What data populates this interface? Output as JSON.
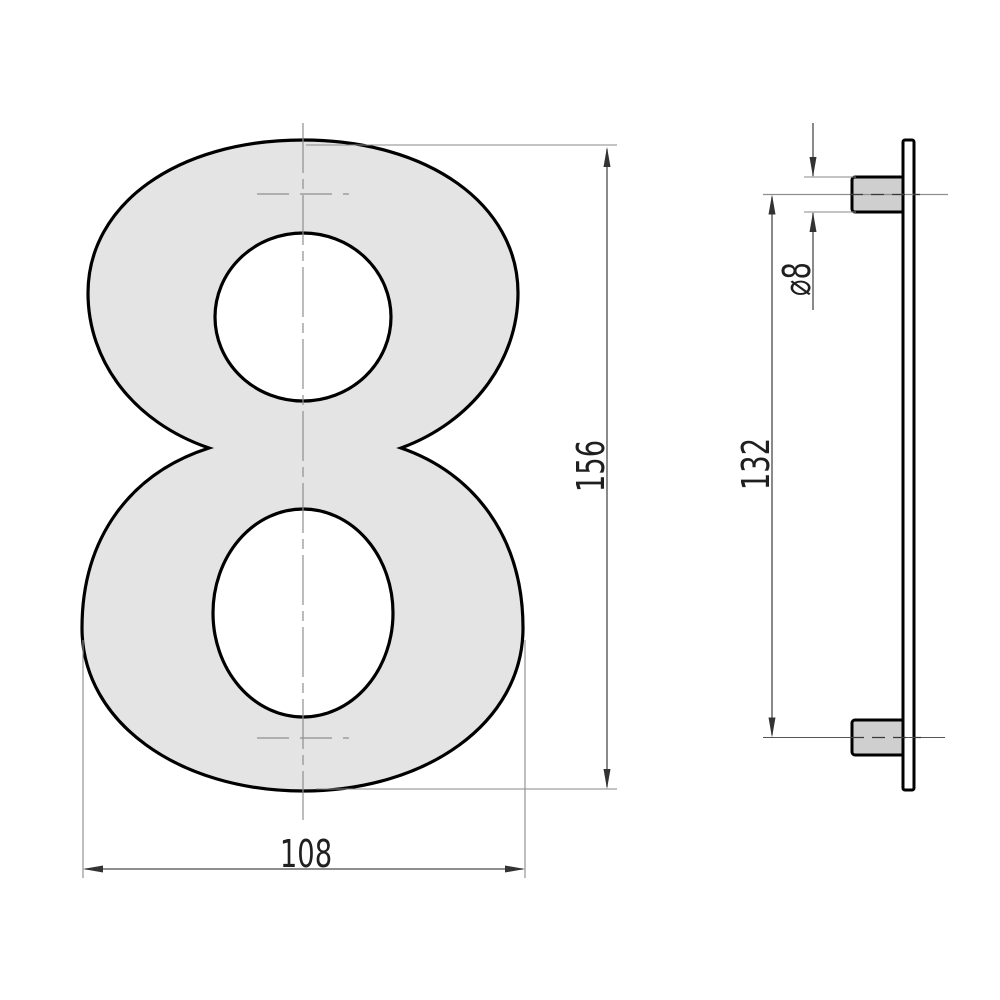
{
  "drawing": {
    "front_view": {
      "numeral": "8",
      "width_label": "108",
      "height_label": "156"
    },
    "side_view": {
      "diameter_label": "⌀8",
      "spacing_label": "132"
    },
    "colors": {
      "numeral_fill": "#e4e4e4",
      "peg_fill": "#cfcfcf",
      "outline": "#000000",
      "dimension_lines": "#4a4a4a",
      "centerlines": "#8f8f8f",
      "background": "#ffffff"
    }
  }
}
